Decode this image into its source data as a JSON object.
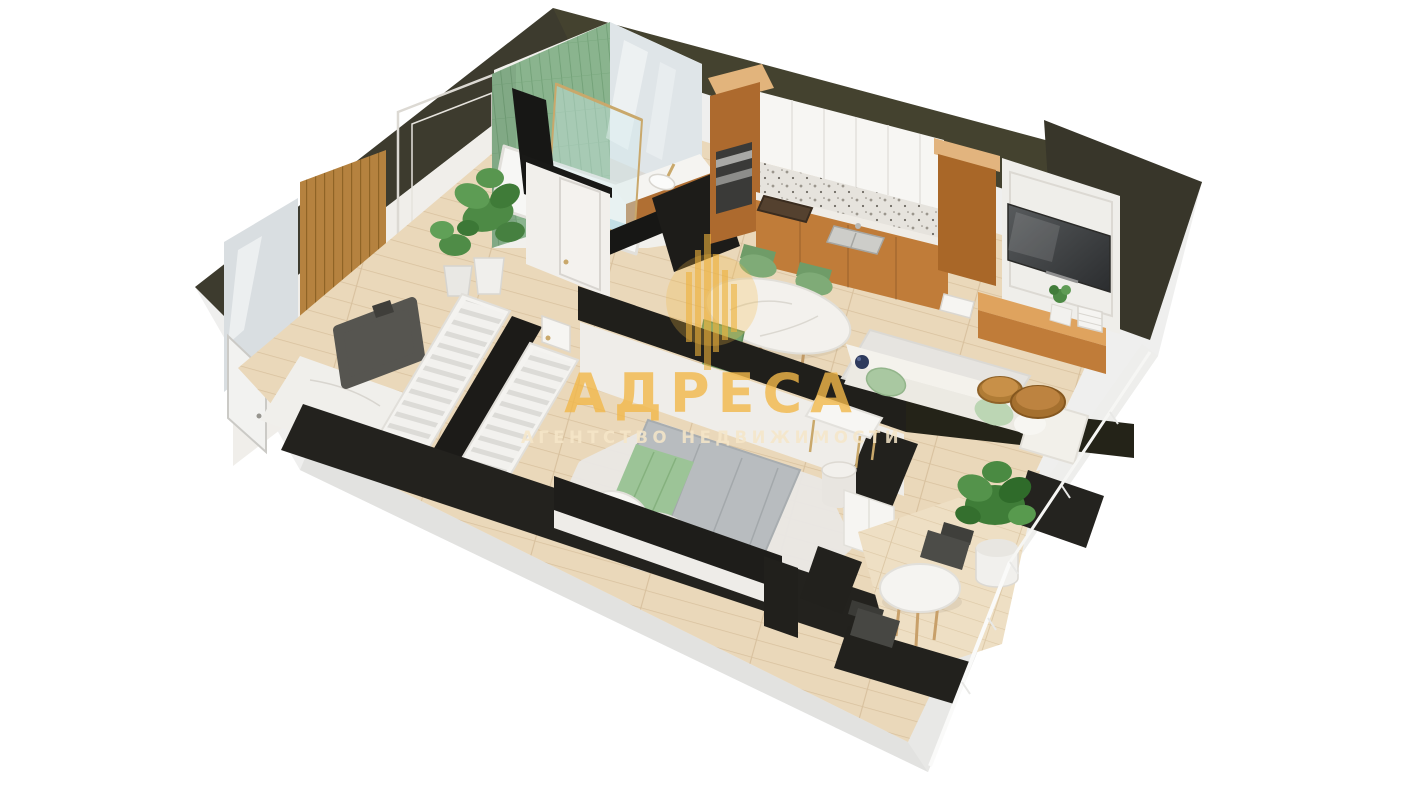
{
  "watermark": {
    "title": "АДРЕСА",
    "subtitle": "АГЕНТСТВО НЕДВИЖИМОСТИ",
    "logo": "circle-with-skyline-bars",
    "title_color": "#f2b84a",
    "subtitle_color": "#f6e7c9"
  },
  "scene": {
    "type": "3d-floor-plan-render",
    "view": "isometric-cutaway-apartment",
    "background": "#ffffff",
    "rooms": [
      {
        "name": "bathroom",
        "features": [
          "green-tiled-walls",
          "bathtub",
          "glass-shower-screen",
          "vanity-sink",
          "mirror-wall",
          "wood-vanity-cabinet"
        ]
      },
      {
        "name": "entry-hall",
        "features": [
          "entrance-door",
          "wall-mirror",
          "wood-slat-partition",
          "gray-bench",
          "potted-plants",
          "marble-floor",
          "molded-wall-panels"
        ]
      },
      {
        "name": "kitchen",
        "features": [
          "tall-wood-cabinets",
          "white-upper-cabinets",
          "marble-backsplash",
          "built-in-oven",
          "cooktop",
          "sink"
        ]
      },
      {
        "name": "dining-area",
        "features": [
          "oval-marble-table",
          "green-chairs"
        ]
      },
      {
        "name": "living-area",
        "features": [
          "wall-mounted-tv",
          "paneled-tv-wall",
          "wood-media-bench",
          "white-sofa",
          "green-cushions",
          "round-coffee-tables",
          "rug",
          "blue-vase"
        ]
      },
      {
        "name": "wardrobe-corridor",
        "features": [
          "two-open-wardrobes-with-hangers",
          "interior-door"
        ]
      },
      {
        "name": "bedroom",
        "features": [
          "double-bed",
          "gray-blanket",
          "green-throw",
          "white-pillows",
          "fluffy-rug",
          "vanity-desk",
          "drum-stool",
          "white-cabinet"
        ]
      },
      {
        "name": "balcony",
        "features": [
          "round-white-table",
          "dark-chairs",
          "large-potted-plant",
          "glass-balustrade"
        ]
      }
    ],
    "palette": {
      "wall_top_dark": "#3b392c",
      "wall_edge_black": "#1c1b18",
      "wall_face_white": "#f1efeb",
      "slab_side": "#e6e6e4",
      "floor_wood": "#ead8ba",
      "floor_marble": "#f0efeb",
      "tile_green": "#8ab48e",
      "cabinet_wood": "#c07c39",
      "cabinet_white": "#f7f6f3",
      "sofa_white": "#f3f1ea",
      "accent_green": "#7fab77",
      "bed_gray": "#b8bcbf",
      "bed_green": "#9cc497",
      "tv_screen": "#3c3e40",
      "watermark_gold": "#f2b84a"
    }
  }
}
